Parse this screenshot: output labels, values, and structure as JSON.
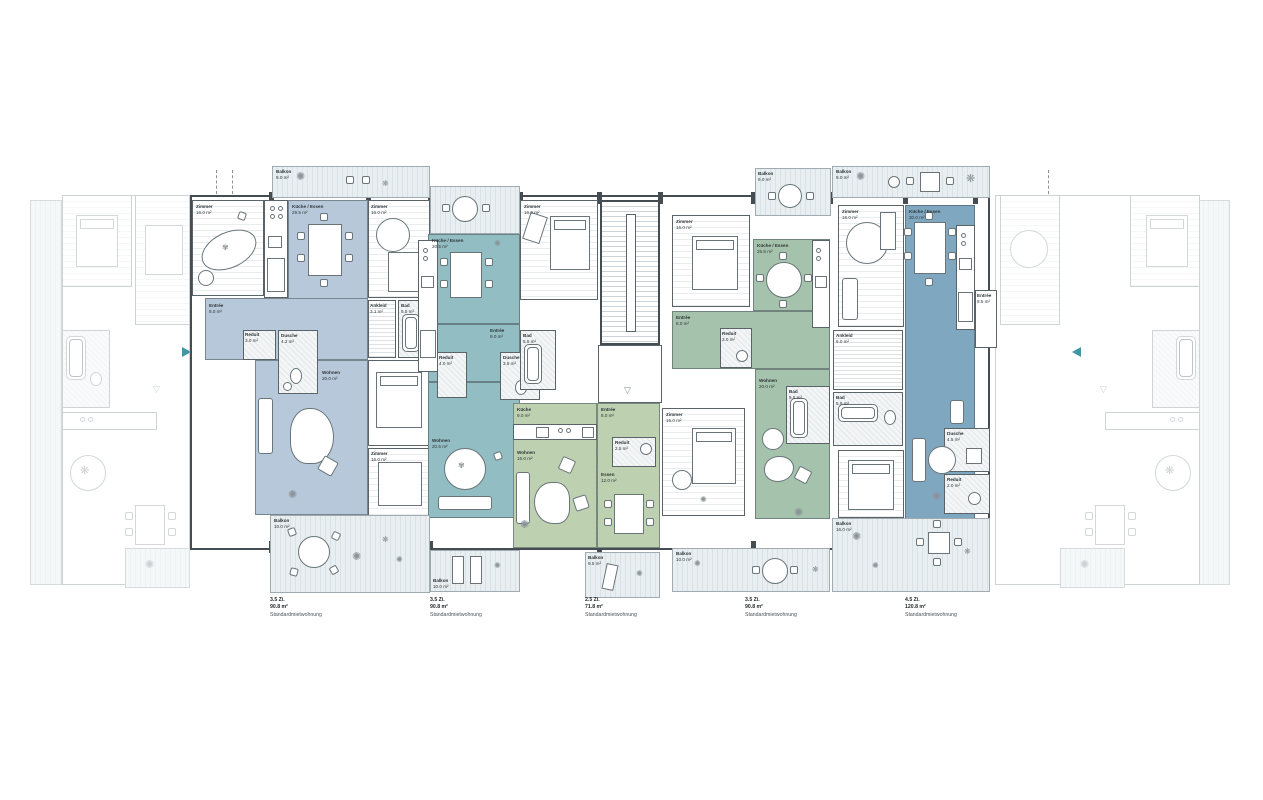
{
  "plan": {
    "title": "floor-plan",
    "captions": [
      {
        "rooms": "3.5 Zi.",
        "area": "90.8 m²",
        "note": "Standardmietwohnung"
      },
      {
        "rooms": "3.5 Zi.",
        "area": "90.8 m²",
        "note": "Standardmietwohnung"
      },
      {
        "rooms": "2.5 Zi.",
        "area": "71.8 m²",
        "note": "Standardmietwohnung"
      },
      {
        "rooms": "3.5 Zi.",
        "area": "90.8 m²",
        "note": "Standardmietwohnung"
      },
      {
        "rooms": "4.5 Zi.",
        "area": "120.8 m²",
        "note": "Standardmietwohnung"
      }
    ],
    "colors": {
      "apartment_1": "#b6c8d9",
      "apartment_2": "#92bdc3",
      "apartment_3": "#bdd1b1",
      "apartment_4": "#a5c2ac",
      "apartment_5": "#7fa8c0",
      "walls": "#454d52",
      "balcony_stripe": "#d9e2e6",
      "neighbour_faded": "#9aa4a9",
      "entry_arrow": "#3f96a6"
    },
    "units": [
      {
        "id": "apartment-1",
        "rooms": [
          {
            "name": "Zimmer",
            "area": "16.0 m²"
          },
          {
            "name": "Küche / Essen",
            "area": "29.5 m²"
          },
          {
            "name": "Entrée",
            "area": "8.0 m²"
          },
          {
            "name": "Reduit",
            "area": "3.0 m²"
          },
          {
            "name": "Dusche",
            "area": "4.2 m²"
          },
          {
            "name": "Wohnen",
            "area": "20.0 m²"
          },
          {
            "name": "Balkon",
            "area": "9.0 m²"
          },
          {
            "name": "Balkon",
            "area": "10.0 m²"
          },
          {
            "name": "Ankleid",
            "area": "3.1 m²"
          },
          {
            "name": "Bad",
            "area": "5.5 m²"
          },
          {
            "name": "Zimmer",
            "area": "16.0 m²"
          },
          {
            "name": "Zimmer",
            "area": "16.0 m²"
          }
        ]
      },
      {
        "id": "apartment-2",
        "rooms": [
          {
            "name": "Küche / Essen",
            "area": "20.5 m²"
          },
          {
            "name": "Entrée",
            "area": "9.0 m²"
          },
          {
            "name": "Reduit",
            "area": "4.0 m²"
          },
          {
            "name": "Dusche",
            "area": "3.5 m²"
          },
          {
            "name": "Wohnen",
            "area": "20.5 m²"
          },
          {
            "name": "Zimmer",
            "area": "16.0 m²"
          },
          {
            "name": "Bad",
            "area": "5.5 m²"
          },
          {
            "name": "Balkon",
            "area": "10.0 m²"
          }
        ]
      },
      {
        "id": "apartment-3",
        "rooms": [
          {
            "name": "Küche",
            "area": "9.0 m²"
          },
          {
            "name": "Wohnen",
            "area": "16.0 m²"
          },
          {
            "name": "Entrée",
            "area": "8.0 m²"
          },
          {
            "name": "Reduit",
            "area": "2.5 m²"
          },
          {
            "name": "Essen",
            "area": "12.0 m²"
          },
          {
            "name": "Zimmer",
            "area": "16.0 m²"
          },
          {
            "name": "Balkon",
            "area": "9.5 m²"
          }
        ]
      },
      {
        "id": "apartment-4",
        "rooms": [
          {
            "name": "Zimmer",
            "area": "16.0 m²"
          },
          {
            "name": "Balkon",
            "area": "9.0 m²"
          },
          {
            "name": "Küche / Essen",
            "area": "25.5 m²"
          },
          {
            "name": "Entrée",
            "area": "8.0 m²"
          },
          {
            "name": "Reduit",
            "area": "3.0 m²"
          },
          {
            "name": "Wohnen",
            "area": "20.0 m²"
          },
          {
            "name": "Bad",
            "area": "5.5 m²"
          },
          {
            "name": "Balkon",
            "area": "10.0 m²"
          }
        ]
      },
      {
        "id": "apartment-5",
        "rooms": [
          {
            "name": "Balkon",
            "area": "9.0 m²"
          },
          {
            "name": "Zimmer",
            "area": "16.0 m²"
          },
          {
            "name": "Küche / Essen",
            "area": "30.0 m²"
          },
          {
            "name": "Ankleid",
            "area": "6.0 m²"
          },
          {
            "name": "Bad",
            "area": "5.5 m²"
          },
          {
            "name": "Entrée",
            "area": "8.5 m²"
          },
          {
            "name": "Dusche",
            "area": "4.5 m²"
          },
          {
            "name": "Reduit",
            "area": "2.0 m²"
          },
          {
            "name": "Balkon",
            "area": "16.0 m²"
          }
        ]
      }
    ]
  }
}
